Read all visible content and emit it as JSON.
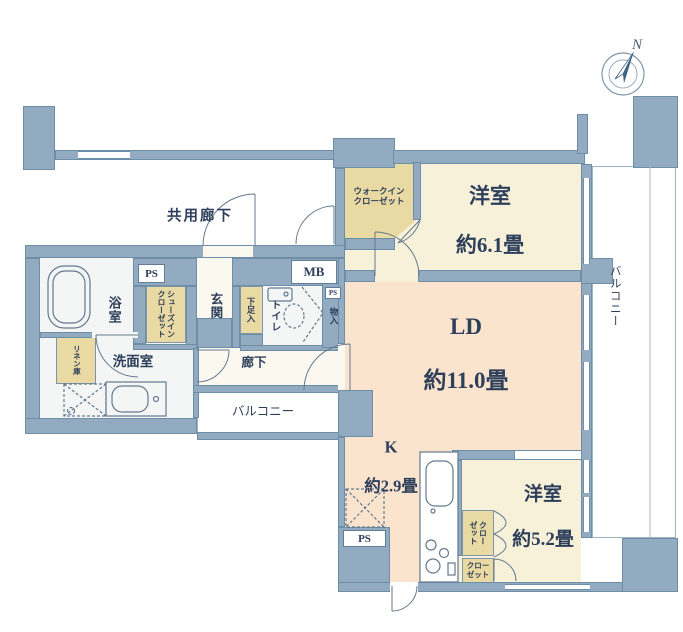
{
  "compass": {
    "north_label": "N"
  },
  "areas": {
    "common_corridor": "共用廊下",
    "bedroom1": {
      "name": "洋室",
      "size": "約6.1畳"
    },
    "living_dining": {
      "name": "LD",
      "size": "約11.0畳"
    },
    "kitchen": {
      "name": "K",
      "size": "約2.9畳"
    },
    "bedroom2": {
      "name": "洋室",
      "size": "約5.2畳"
    },
    "bath": "浴室",
    "washroom": "洗面室",
    "entrance": "玄関",
    "hallway": "廊下",
    "toilet": "トイレ",
    "balcony_right": "バルコニー",
    "balcony_bottom_left": "バルコニー"
  },
  "storage": {
    "walk_in_closet": "ウォークイン\nクローゼット",
    "shoes_in_closet": "シューズイン\nクローゼット",
    "shoe_box": "下足入",
    "storage_small": "物入",
    "linen": "リネン庫",
    "closet_upper": "クロー\nゼット",
    "closet_lower": "クロー\nゼット"
  },
  "utilities": {
    "ps_top": "PS",
    "ps_small": "PS",
    "ps_bottom": "PS",
    "mb": "MB"
  },
  "colors": {
    "wall": "#92abc0",
    "wall_border": "#6e8da6",
    "cream": "#f8f1d9",
    "peach": "#fbe4cd",
    "tan": "#e9d9a2",
    "wet": "#f3f6f5",
    "hall": "#faf8ef",
    "ink": "#2e3f5c",
    "line": "#64798f"
  }
}
